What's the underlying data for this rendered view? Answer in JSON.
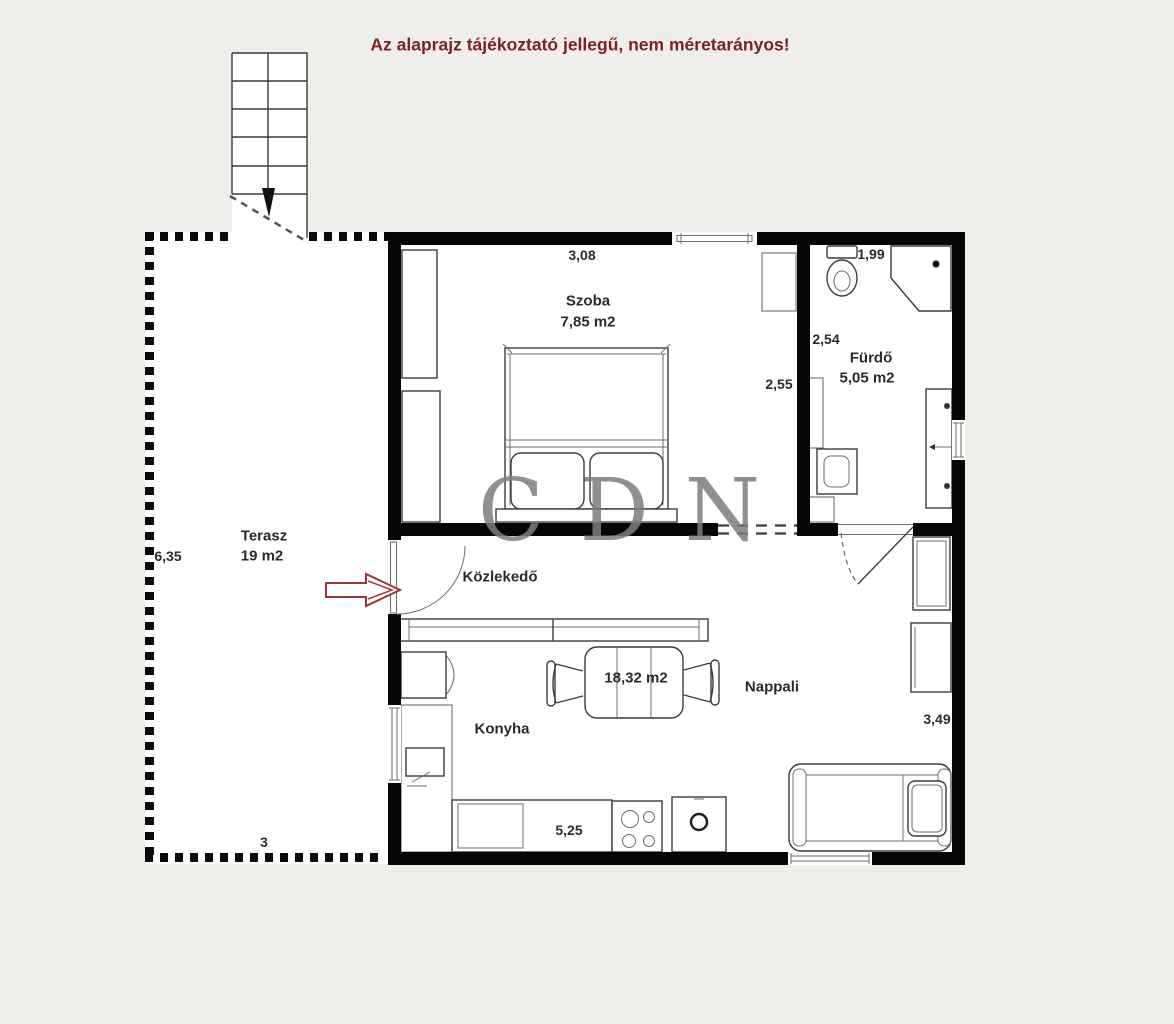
{
  "title": "Az alaprajz tájékoztató jellegű, nem méretarányos!",
  "watermark": "CDN",
  "rooms": {
    "terasz": {
      "name": "Terasz",
      "area": "19 m2"
    },
    "szoba": {
      "name": "Szoba",
      "area": "7,85 m2"
    },
    "furdo": {
      "name": "Fürdő",
      "area": "5,05 m2"
    },
    "kozlekedo": {
      "name": "Közlekedő"
    },
    "konyha": {
      "name": "Konyha"
    },
    "nappali": {
      "name": "Nappali",
      "area": "18,32 m2"
    }
  },
  "dimensions": {
    "szoba_width": "3,08",
    "szoba_depth": "2,55",
    "furdo_width": "1,99",
    "furdo_depth": "2,54",
    "terasz_depth": "6,35",
    "terasz_width": "3",
    "nappali_depth": "3,49",
    "konyha_width": "5,25"
  },
  "colors": {
    "background": "#f0eeea",
    "wall": "#060606",
    "title_text": "#7a2424",
    "entrance_arrow": "#9c3636",
    "label_text": "#2b2b2b"
  }
}
